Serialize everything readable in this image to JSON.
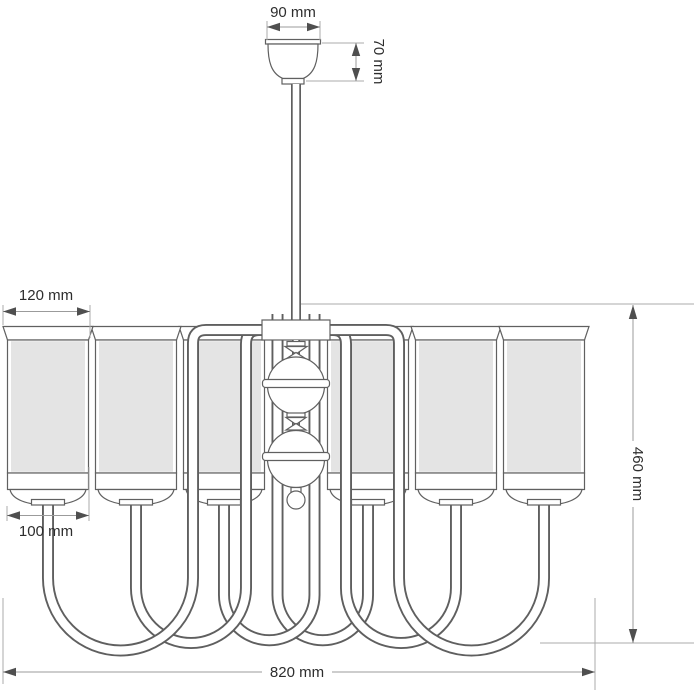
{
  "drawing": {
    "type": "technical-drawing",
    "subject": "six-arm chandelier with cylindrical shades, front elevation with dimensions",
    "dimensions": {
      "canopy_width": {
        "label": "90 mm"
      },
      "canopy_height": {
        "label": "70 mm"
      },
      "shade_top_diameter": {
        "label": "120 mm"
      },
      "shade_bottom_diameter": {
        "label": "100 mm"
      },
      "body_height": {
        "label": "460 mm"
      },
      "overall_width": {
        "label": "820 mm"
      }
    },
    "colors": {
      "background": "#ffffff",
      "outline": "#606060",
      "shade_fill": "#e4e4e4",
      "dimension_line": "#9b9b9b",
      "arrowhead": "#4f4f4f",
      "text": "#2d2d2d"
    },
    "shade_count": 6
  }
}
